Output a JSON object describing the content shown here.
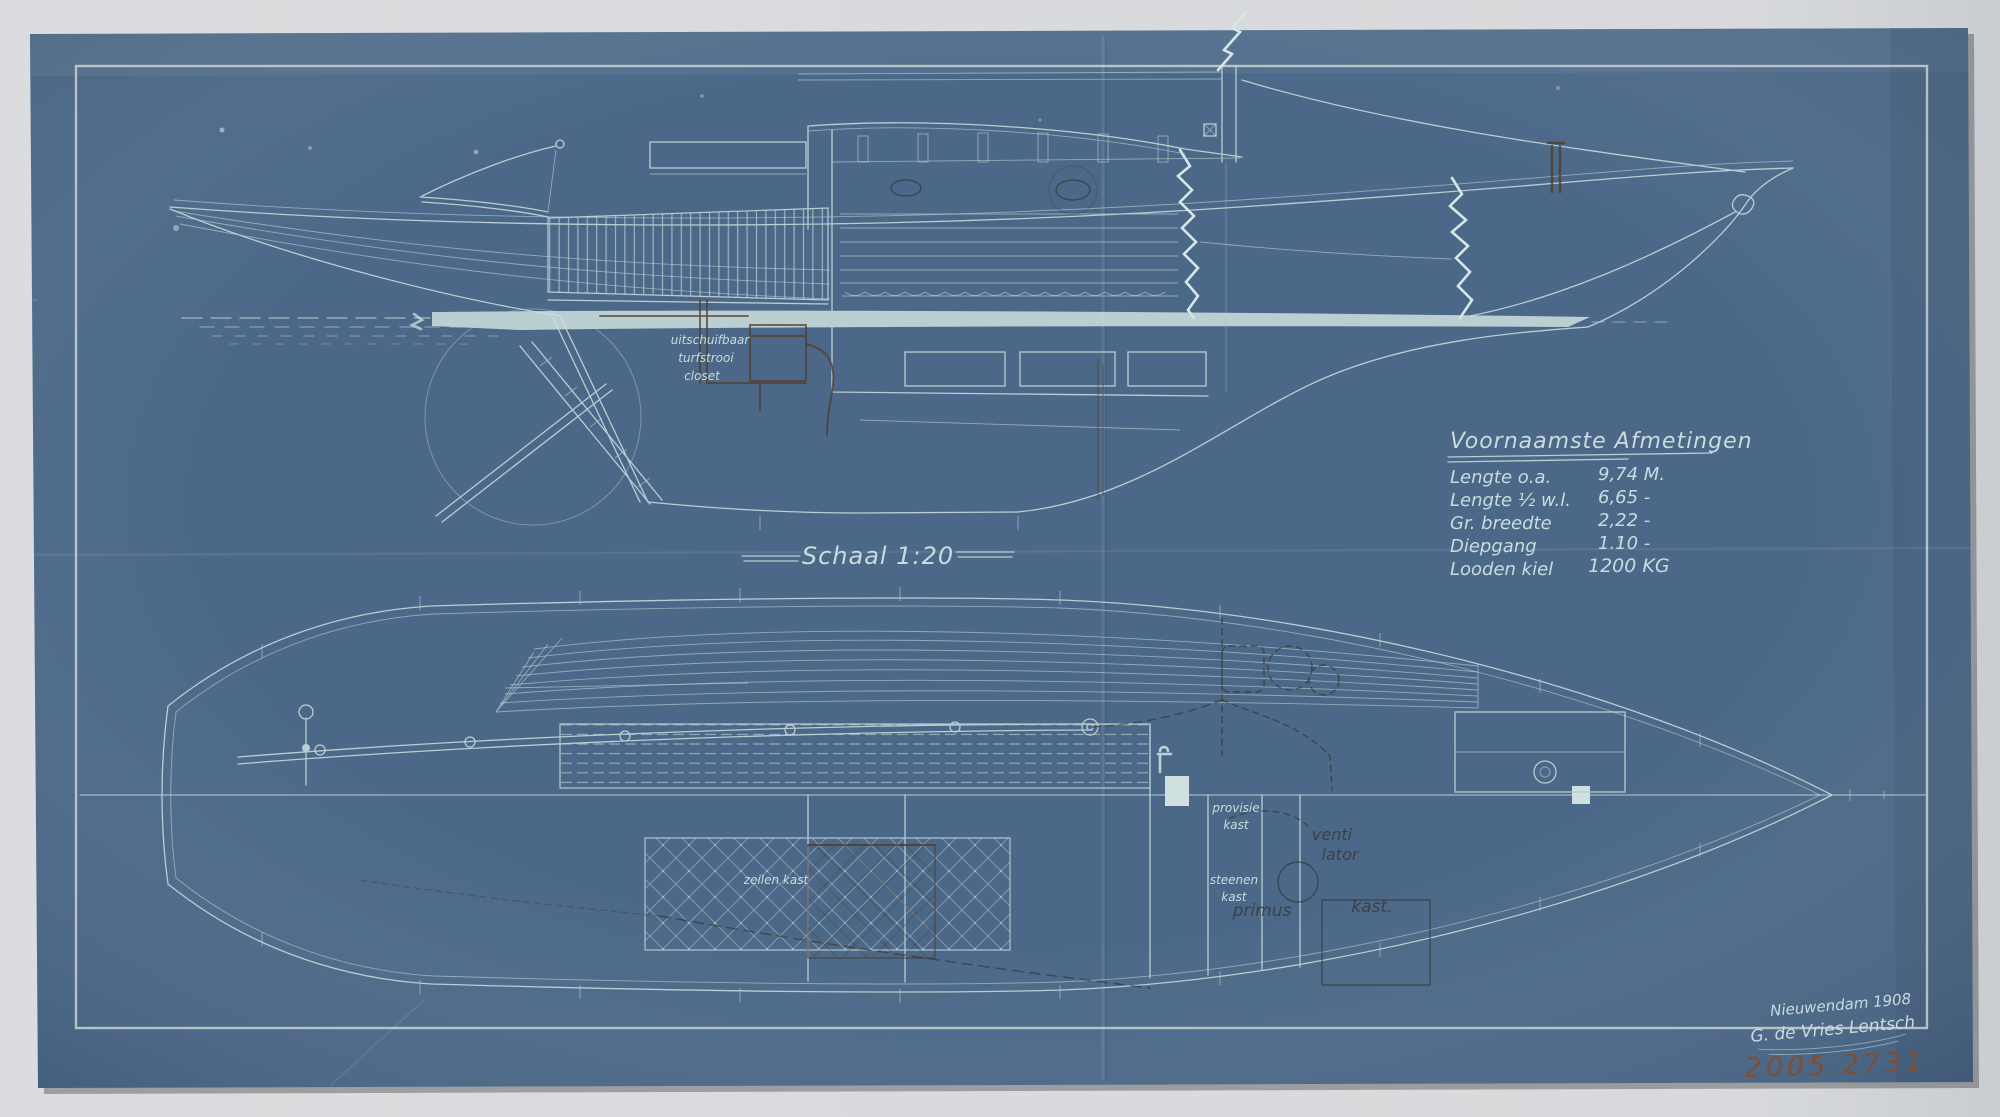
{
  "artwork": {
    "scale_label": "Schaal 1:20",
    "dimensions_table": {
      "title": "Voornaamste Afmetingen",
      "rows": [
        {
          "label": "Lengte o.a.",
          "value": "9,74 M."
        },
        {
          "label": "Lengte ½ w.l.",
          "value": "6,65  -"
        },
        {
          "label": "Gr. breedte",
          "value": "2,22  -"
        },
        {
          "label": "Diepgang",
          "value": "1.10  -"
        },
        {
          "label": "Looden kiel",
          "value": "1200 KG"
        }
      ]
    },
    "annotations": {
      "closet_line1": "uitschuifbaar",
      "closet_line2": "turfstrooi",
      "closet_line3": "closet",
      "sail_locker": "zeilen kast",
      "provisions_line1": "provisie",
      "provisions_line2": "kast",
      "stone_cupboard_line1": "steenen",
      "stone_cupboard_line2": "kast",
      "ventilator_line1": "venti",
      "ventilator_line2": "lator",
      "primus": "primus",
      "kast": "kast.",
      "scale_dash": "—"
    },
    "signature": {
      "place_and_year": "Nieuwendam 1908",
      "builder": "G. de Vries Lentsch",
      "accession_number": "2005.2731"
    },
    "colors": {
      "paper": "#4b6888",
      "drawing_line": "#b9cdd2",
      "bright_line": "#d7e7e6",
      "backdrop": "#d9dbde",
      "pencil": "#35312a",
      "brown_ink": "#533d2b",
      "accession_ink": "#7d4f36"
    }
  }
}
